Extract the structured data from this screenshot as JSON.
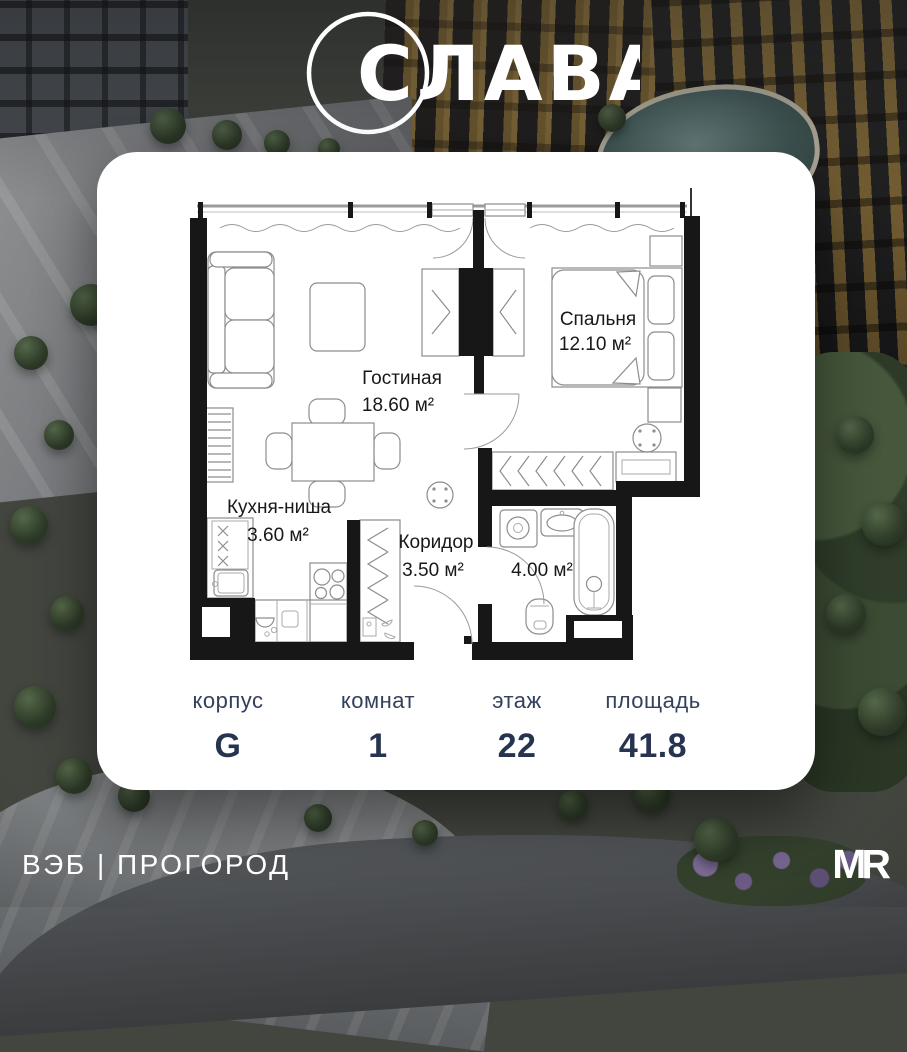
{
  "logo": {
    "title": "СЛАВА"
  },
  "plan": {
    "rooms": [
      {
        "name": "Гостиная",
        "area": "18.60 м²"
      },
      {
        "name": "Спальня",
        "area": "12.10 м²"
      },
      {
        "name": "Кухня-ниша",
        "area": "3.60 м²"
      },
      {
        "name": "Коридор",
        "area": "3.50 м²"
      },
      {
        "name": "",
        "area": "4.00 м²"
      }
    ]
  },
  "stats": {
    "items": [
      {
        "label": "корпус",
        "value": "G"
      },
      {
        "label": "комнат",
        "value": "1"
      },
      {
        "label": "этаж",
        "value": "22"
      },
      {
        "label": "площадь",
        "value": "41.8"
      }
    ]
  },
  "footer": {
    "developer": "ВЭБ | ПРОГОРОД",
    "brand": "MR"
  }
}
